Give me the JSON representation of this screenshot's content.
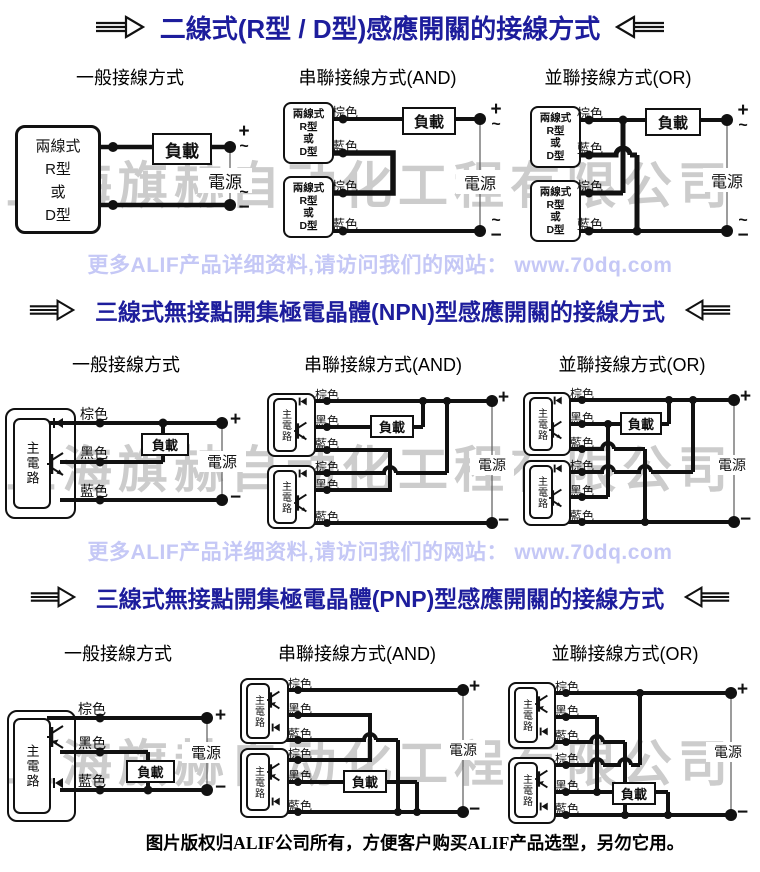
{
  "page": {
    "watermark": "上海旗赫自动化工程有限公司",
    "promo_line": "更多ALIF产品详细资料,请访问我们的网站： www.70dq.com",
    "copyright_line": "图片版权归ALIF公司所有，方便客户购买ALIF产品选型，另勿它用。"
  },
  "sections": [
    {
      "title": "二線式(R型 / D型)感應開關的接線方式"
    },
    {
      "title": "三線式無接點開集極電晶體(NPN)型感應開關的接線方式"
    },
    {
      "title": "三線式無接點開集極電晶體(PNP)型感應開關的接線方式"
    }
  ],
  "column_headers": {
    "general": "一般接線方式",
    "series": "串聯接線方式(AND)",
    "parallel": "並聯接線方式(OR)"
  },
  "labels": {
    "two_wire_box": [
      "兩線式",
      "R型",
      "或",
      "D型"
    ],
    "main_circuit": "主電路",
    "brown": "棕色",
    "black": "黑色",
    "blue": "藍色",
    "load": "負載",
    "power": "電源"
  },
  "terminals": {
    "plus": "+",
    "minus": "−",
    "ac": "~"
  },
  "colors": {
    "title": "#1d1d9c",
    "promo_text": "#c5c8f6",
    "watermark": "#cccccc",
    "wire": "#111111"
  }
}
